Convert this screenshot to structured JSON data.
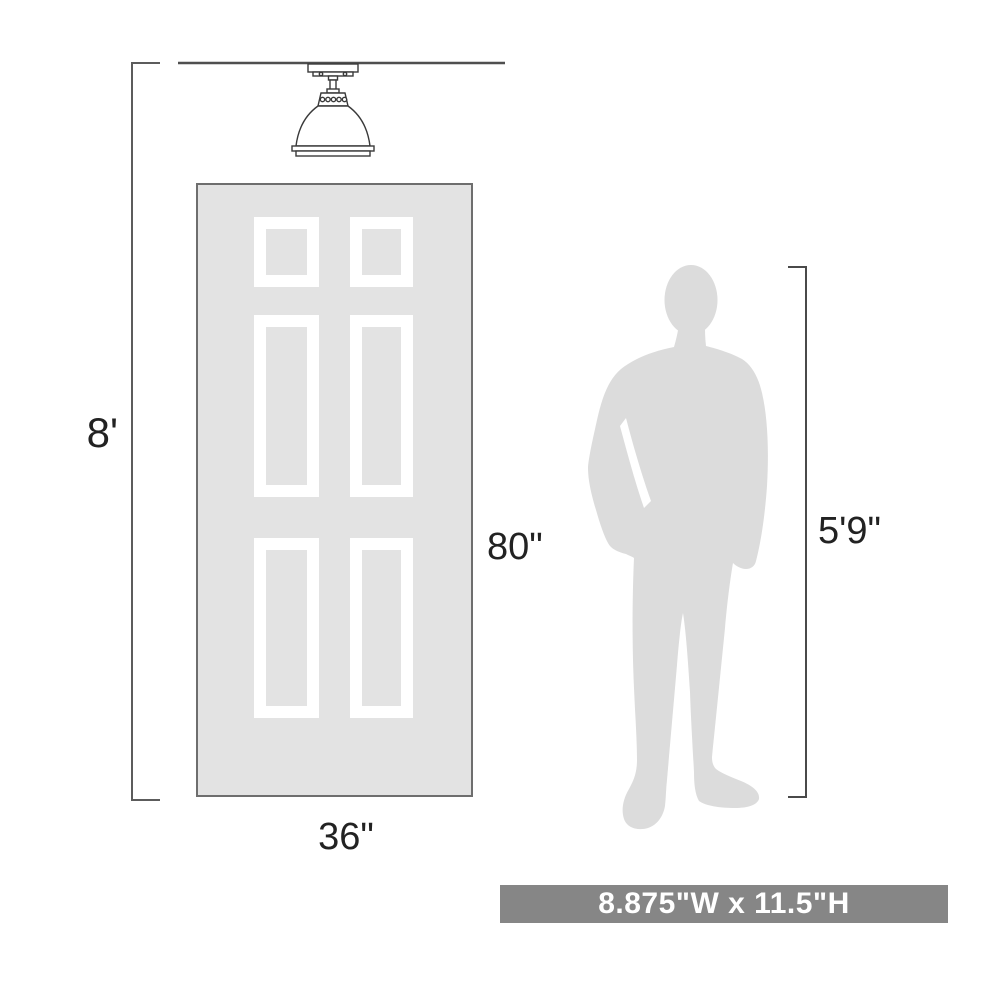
{
  "diagram": {
    "type": "product-dimension-diagram",
    "labels": {
      "ceiling_height": "8'",
      "door_height": "80\"",
      "door_width": "36\"",
      "person_height": "5'9\""
    },
    "banner": {
      "text": "8.875\"W x 11.5\"H"
    },
    "illustrations": {
      "fixture": "semi-flush-dome-ceiling-light",
      "door": "six-panel-door",
      "person": "standing-man-silhouette"
    },
    "colors": {
      "background": "#ffffff",
      "door_fill": "#e3e3e3",
      "door_border": "#6e6e6e",
      "panel_frame": "#ffffff",
      "silhouette_fill": "#dcdcdc",
      "dimension_line": "#5c5c5c",
      "label_text": "#222222",
      "banner_bg": "#868686",
      "banner_text": "#ffffff"
    }
  }
}
